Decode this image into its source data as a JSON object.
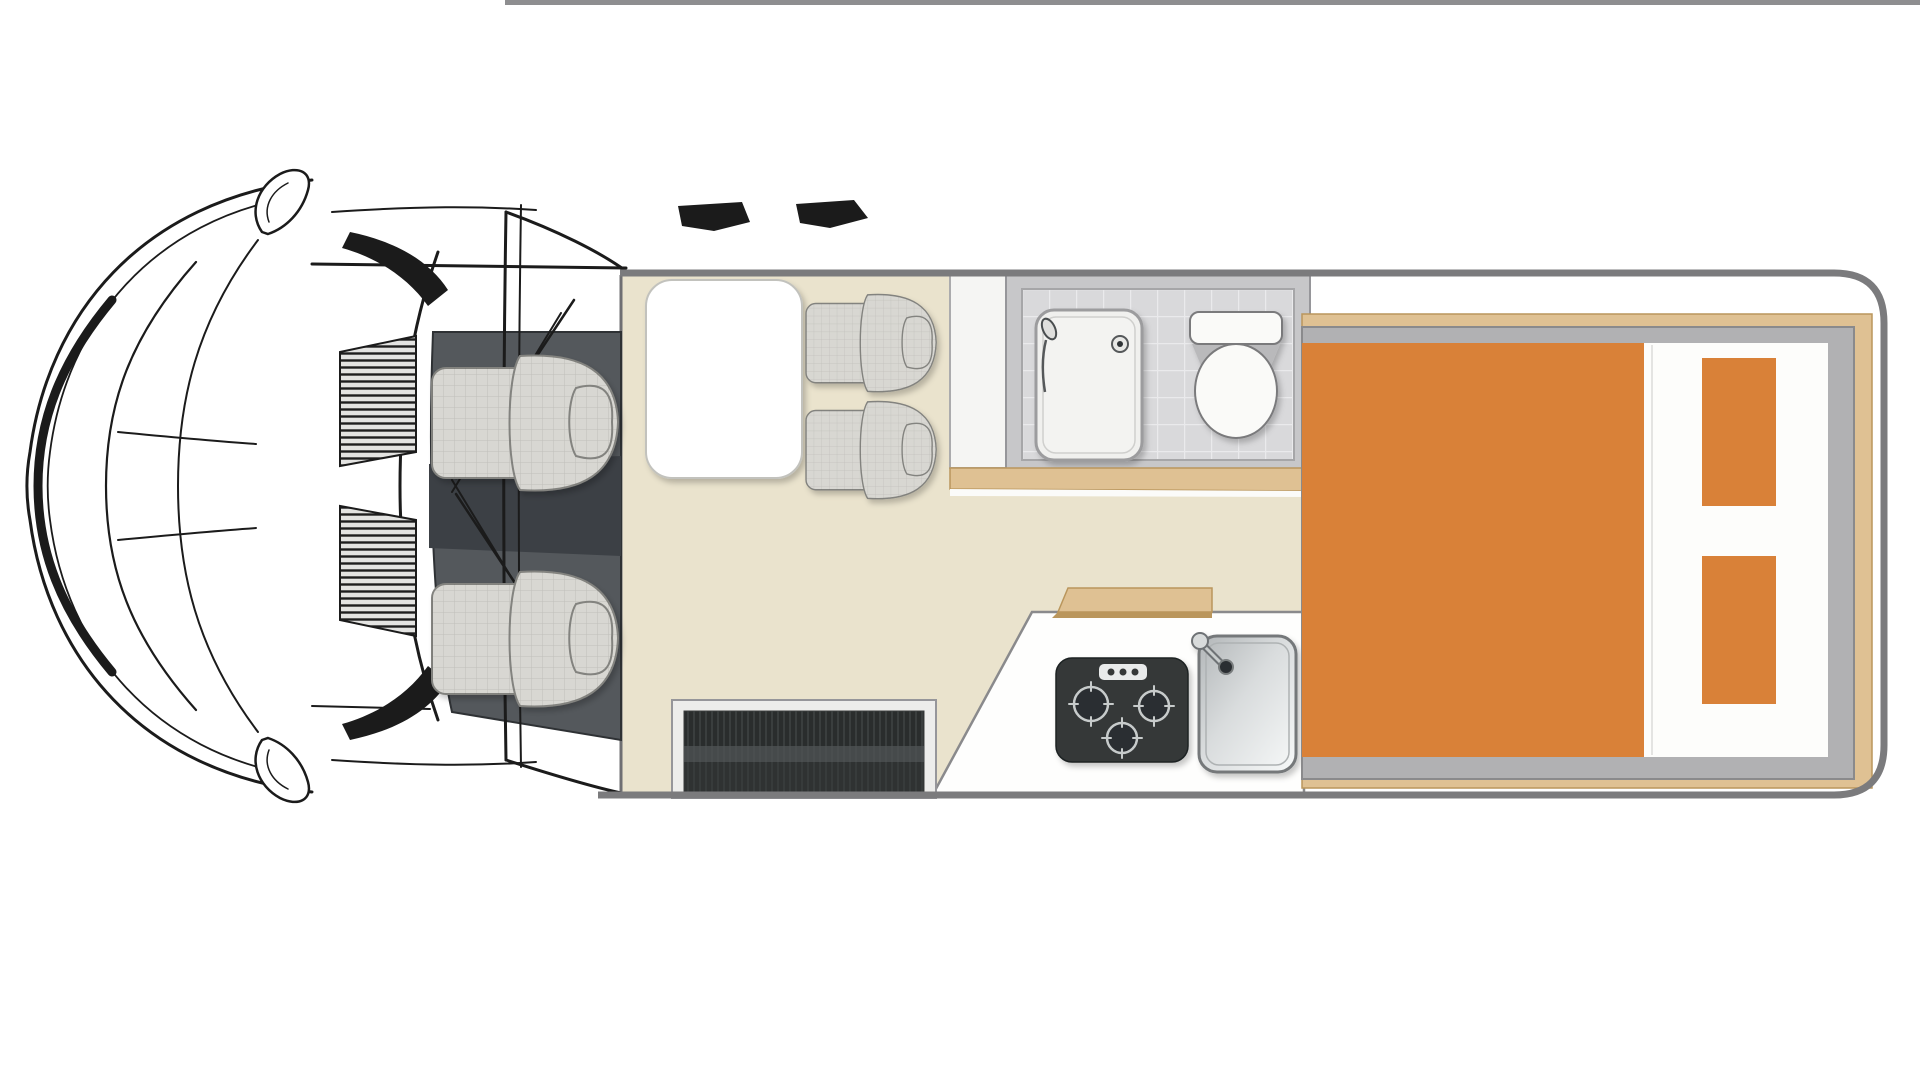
{
  "scene": {
    "type": "vehicle floor plan",
    "vehicle": "campervan motorhome",
    "view": "top-down",
    "front_direction": "left"
  },
  "colors": {
    "floor": "#EAE3CD",
    "wood": "#DFC193",
    "wood_dark": "#BA965C",
    "mattress": "#D98138",
    "body_line": "#7B7B7D",
    "wall": "#C7C7C9",
    "wall_line": "#96969A",
    "tile": "#D9D9DB",
    "grout": "#EAEAEC",
    "cab_floor": "#54585C",
    "cab_floor_dark": "#3C4045",
    "seat": "#D8D7D2",
    "seat_line": "#83837F",
    "ink": "#1B1B1B",
    "counter": "#FEFEFD",
    "counter_line": "#8A8A8C",
    "hob": "#343839",
    "hob_ring": "#C7CBCB",
    "hob_well": "#2B2F30",
    "knob_panel": "#E9EBEB",
    "sink_line": "#74787A",
    "step_frame": "#EDEDEB",
    "step_dark": "#2A2D2D",
    "step_stripe": "#3A3E3E",
    "step_sheen": "#505455",
    "fixture_fill": "#FAFAF8",
    "fixture_line": "#7A7A7C",
    "divider": "#F5F5F3",
    "top_rule": "#8E8E90",
    "white": "#FFFFFF"
  },
  "cab": {
    "seats": 2,
    "mirrors": 2,
    "wipers": 2,
    "hood_vents": 2
  },
  "lounge": {
    "table": "white rounded rectangle",
    "travel_seats": 2,
    "entry_step": "dark ribbed mat"
  },
  "bathroom": {
    "shower_tray": 1,
    "hand_shower": 1,
    "shower_drain": 1,
    "toilet": 1,
    "floor": "gray tile"
  },
  "kitchen": {
    "hob_burners": 3,
    "hob_knobs": 3,
    "sink": 1,
    "faucet": 1,
    "sink_drain": 1,
    "overhead_locker": 1
  },
  "bedroom": {
    "bed": "rear transverse double",
    "pillows": 2,
    "trim": "wood with gray frame"
  }
}
